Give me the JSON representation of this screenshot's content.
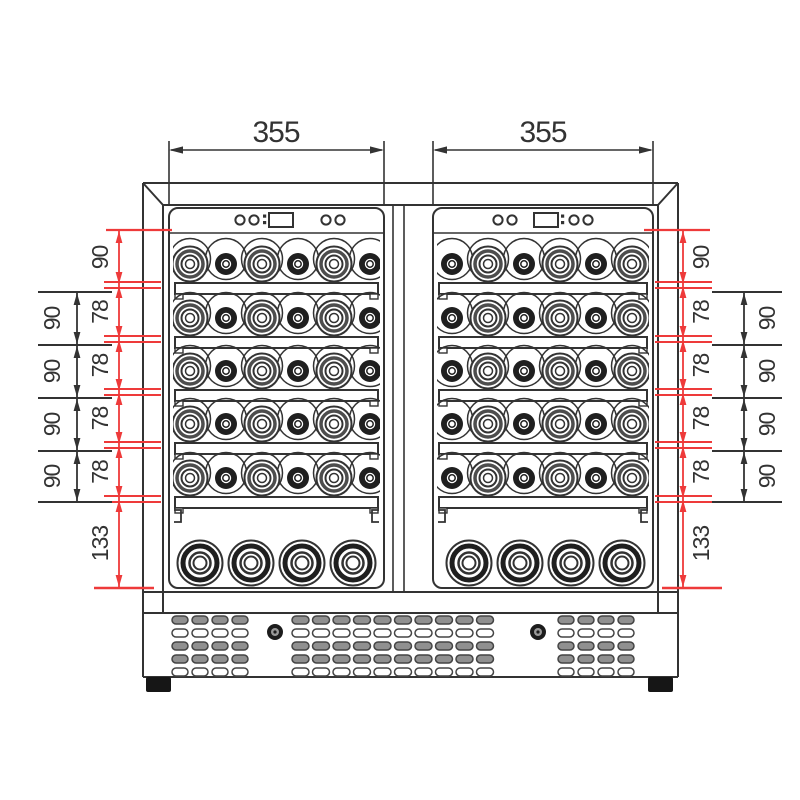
{
  "drawing": {
    "subject": "dual-zone wine cooler front elevation technical drawing",
    "colors": {
      "line": "#333333",
      "dimension_red": "#ee3a3a",
      "dimension_black": "#333333",
      "background": "#ffffff",
      "vent_fill": "#909090",
      "foot_fill": "#161616"
    },
    "dimensions": {
      "top": [
        "355",
        "355"
      ],
      "left_red": [
        "90",
        "78",
        "78",
        "78",
        "78",
        "133"
      ],
      "left_black": [
        "90",
        "90",
        "90",
        "90"
      ],
      "right_red": [
        "90",
        "78",
        "78",
        "78",
        "78",
        "133"
      ],
      "right_black": [
        "90",
        "90",
        "90",
        "90"
      ]
    },
    "cabinet": {
      "doors": 2,
      "shelves_per_door": 5,
      "bottles_per_shelf": 6,
      "bin_bottles_per_door": 4,
      "control_buttons_per_door": 4,
      "display_per_door": 1,
      "vent_groups": 3,
      "vent_rows": 5,
      "screws": 2,
      "feet": 2
    }
  }
}
